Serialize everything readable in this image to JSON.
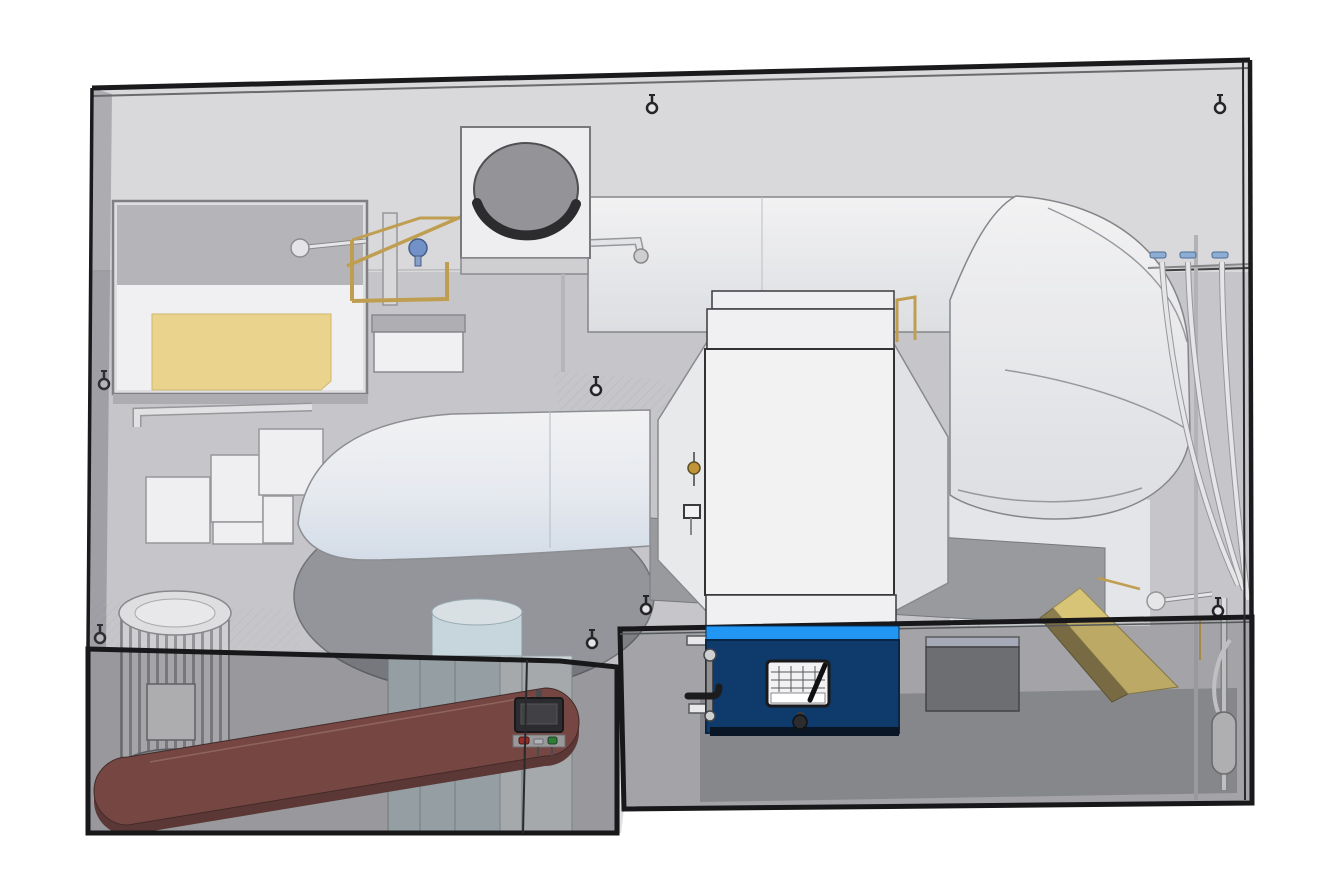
{
  "scene": {
    "type": "3d-cad-render",
    "title": "Enclosed industrial burner / air-handling skid",
    "description": "Isometric CAD view of a machine skid inside a transparent smoked-glass enclosure: supply fan scroll housing with belt-drive motor, open water tank with yellow liner and float valve, intake filter box with circular disc, overhead white supply duct with right-hand elbow, central heater chamber with navy burner cabinet, spray-nozzle rack with drop tubes, yellow deflector ramp and brass gas piping.",
    "background": "#ffffff"
  },
  "colors": {
    "burner_body": "#0e3a6c",
    "burner_top_strip": "#2196f3",
    "burner_bottom": "#0a1626",
    "tank_liner_yellow": "#f6dd8d",
    "ramp_yellow_top": "#e3cc74",
    "ramp_yellow_side": "#8d7d48",
    "belt_top": "#95514a",
    "belt_side": "#6f3c35",
    "brass_pipe": "#c7a24b",
    "valve_knob_blue": "#7193cf",
    "nozzle_handle_blue": "#8fb4dd",
    "display_button_red": "#cc2a22",
    "display_button_white": "#ededef",
    "display_button_green": "#2f9e3a",
    "shaft_cylinder": "#cfe0e6",
    "intake_disc": "#97979a",
    "floor_gray": "#cfcfd2",
    "wall_gray": "#e4e4e6"
  },
  "parts": {
    "enclosure": "transparent smoked-glass enclosure with black edges",
    "lower_left_glass_box": "darker glass guard box over motor and belt",
    "lower_right_glass_band": "darker glass guard band across right half",
    "water_tank": "open water tank with yellow liner and float-ball valve",
    "step_panels": "cascading white access panels",
    "intake_box": "intake filter box with circular damper disc",
    "supply_duct": "overhead white supply duct",
    "elbow_duct": "large right-hand duct elbow",
    "heater_chamber": "central white heater chamber with flared side walls",
    "burner_cabinet": "navy burner cabinet with hinged door, handle, nameplate and knob",
    "blower": "white scroll fan housing on round gray base with light-blue shaft column",
    "drive_motor": "finned electric motor with junction box",
    "drive_belt": "maroon flat drive belt loop",
    "pedestal": "light blue-gray pedestal column",
    "control_display": "small panel display with red, white and green buttons",
    "spray_nozzle_rack": "three blue-handled nozzles with white drop tubes",
    "deflector_ramp": "yellow slanted deflector ramp",
    "gray_junction_box": "gray electrical box with pale blue lid strip",
    "gas_train": "brass gas piping cluster with blue valve knob",
    "float_valves": "two white float balls on rods",
    "accumulator": "vertical capsule tank at right wall",
    "lifting_eyes": "eight lifting-eye bolts on panels and roof"
  }
}
